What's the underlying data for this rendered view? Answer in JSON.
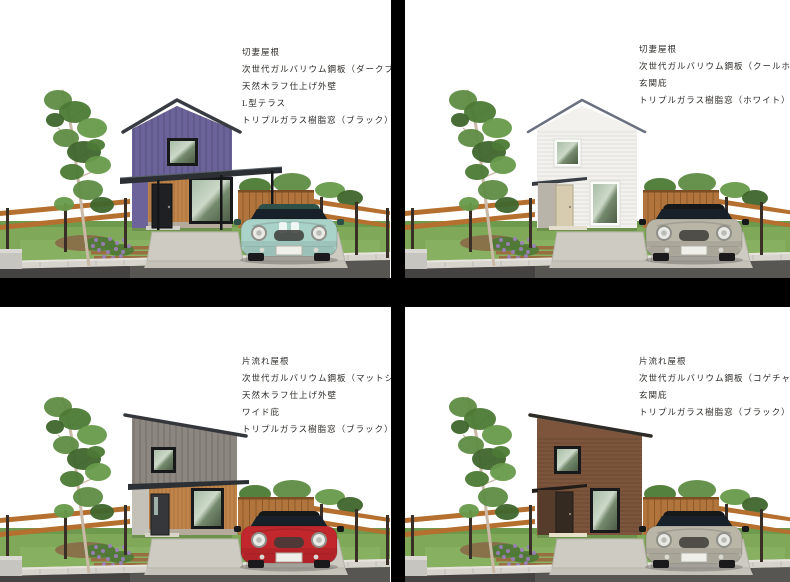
{
  "page": {
    "background": "#ffffff"
  },
  "dividers": {
    "color": "#000000"
  },
  "panels": [
    {
      "title": "top-left-house-dark-blue",
      "specs": [
        "切妻屋根",
        "次世代ガルバリウム鋼板（ダークブルー）",
        "天然木ラフ仕上げ外壁",
        "L型テラス",
        "トリプルガラス樹脂窓（ブラック）"
      ],
      "house": {
        "roof": "gable",
        "scheme": "two-tone",
        "upper_color": "#6b6399",
        "wood_color": "#c08449",
        "door_color": "#1e2023",
        "window_frame": "#17191b",
        "feature": "l-terrace",
        "roof_edge": "#383c42"
      },
      "car": {
        "body": "#a9d2c9",
        "roof": "#2f4f49",
        "stripes": true
      }
    },
    {
      "title": "top-right-house-cool-white",
      "specs": [
        "切妻屋根",
        "次世代ガルバリウム鋼板（クールホワイト）",
        "玄関庇",
        "トリプルガラス樹脂窓（ホワイト）"
      ],
      "house": {
        "roof": "gable",
        "scheme": "mono",
        "upper_color": "#f2f1ed",
        "siding_line": "#dbdad4",
        "door_color": "#d8ccb0",
        "window_frame": "#fbfbf9",
        "feature": "entry-canopy",
        "roof_edge": "#6b7080"
      },
      "car": {
        "body": "#b9b5a7",
        "roof": "#17181a",
        "stripes": false
      }
    },
    {
      "title": "bottom-left-house-matte-silver",
      "specs": [
        "片流れ屋根",
        "次世代ガルバリウム鋼板（マットシルバー）",
        "天然木ラフ仕上げ外壁",
        "ワイド庇",
        "トリプルガラス樹脂窓（ブラック）"
      ],
      "house": {
        "roof": "shed",
        "scheme": "two-tone",
        "upper_color": "#8d8781",
        "wood_color": "#c08449",
        "door_color": "#35373a",
        "window_frame": "#17191b",
        "feature": "wide-canopy",
        "roof_edge": "#33363b"
      },
      "car": {
        "body": "#c1272d",
        "roof": "#17181a",
        "stripes": false
      }
    },
    {
      "title": "bottom-right-house-dark-brown",
      "specs": [
        "片流れ屋根",
        "次世代ガルバリウム鋼板（コゲチャ）",
        "玄関庇",
        "トリプルガラス樹脂窓（ブラック）"
      ],
      "house": {
        "roof": "shed",
        "scheme": "mono",
        "upper_color": "#7d553c",
        "siding_line": "#00000030",
        "door_color": "#342a22",
        "window_frame": "#17191b",
        "feature": "entry-canopy",
        "roof_edge": "#2f2b27"
      },
      "car": {
        "body": "#b9b5a7",
        "roof": "#17181a",
        "stripes": false
      }
    }
  ],
  "scene": {
    "grass": "#7fa859",
    "grass_dark": "#6d9a4c",
    "grass_light": "#93bb6b",
    "slab": "#cecbc2",
    "slab_edge": "#b7b4ab",
    "apron": "#c5c2ba",
    "curb": "#d6d4cd",
    "curb_top": "#e6e4dd",
    "road": "#575653",
    "road_dark": "#3c3c3a",
    "rail": "#b5702f",
    "post": "#3a2f26",
    "board_fence": "#b0743c",
    "board_gap": "#8f5a2a",
    "board_cap": "#7d4e24",
    "dirt": "#8a6a48",
    "path": "#9a6c3f",
    "flower": "#9b7fc0",
    "block": "#c6c5c0",
    "trunk": "#c9b9a6",
    "leaf1": "#5e8c43",
    "leaf2": "#4c7a35",
    "leaf3": "#679a4a",
    "leaf4": "#3f652c",
    "base": "#b3afa5",
    "terrace_roof": "#2c3034"
  }
}
